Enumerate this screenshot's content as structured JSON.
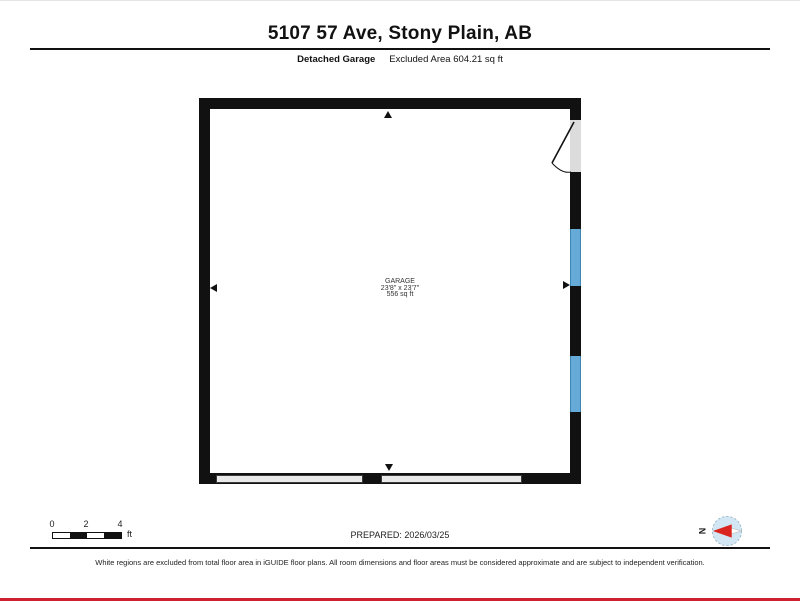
{
  "header": {
    "title": "5107 57 Ave, Stony Plain, AB",
    "floor_label": "Detached Garage",
    "area_label": "Excluded Area 604.21 sq ft"
  },
  "floorplan": {
    "room": {
      "name": "GARAGE",
      "dimensions": "23'8\" x 23'7\"",
      "area": "556 sq ft"
    },
    "colors": {
      "wall": "#111111",
      "window": "#66abd8",
      "door_opening_fill": "#dcdcdc",
      "garage_door_fill": "#e9e9e9"
    }
  },
  "footer": {
    "scale": {
      "ticks": [
        "0",
        "2",
        "4"
      ],
      "unit": "ft"
    },
    "prepared": "PREPARED: 2026/03/25",
    "compass_label": "N",
    "disclaimer": "White regions are excluded from total floor area in iGUIDE floor plans. All room dimensions and floor areas must be considered approximate and are subject to independent verification.",
    "accent_color": "#cf2030"
  }
}
